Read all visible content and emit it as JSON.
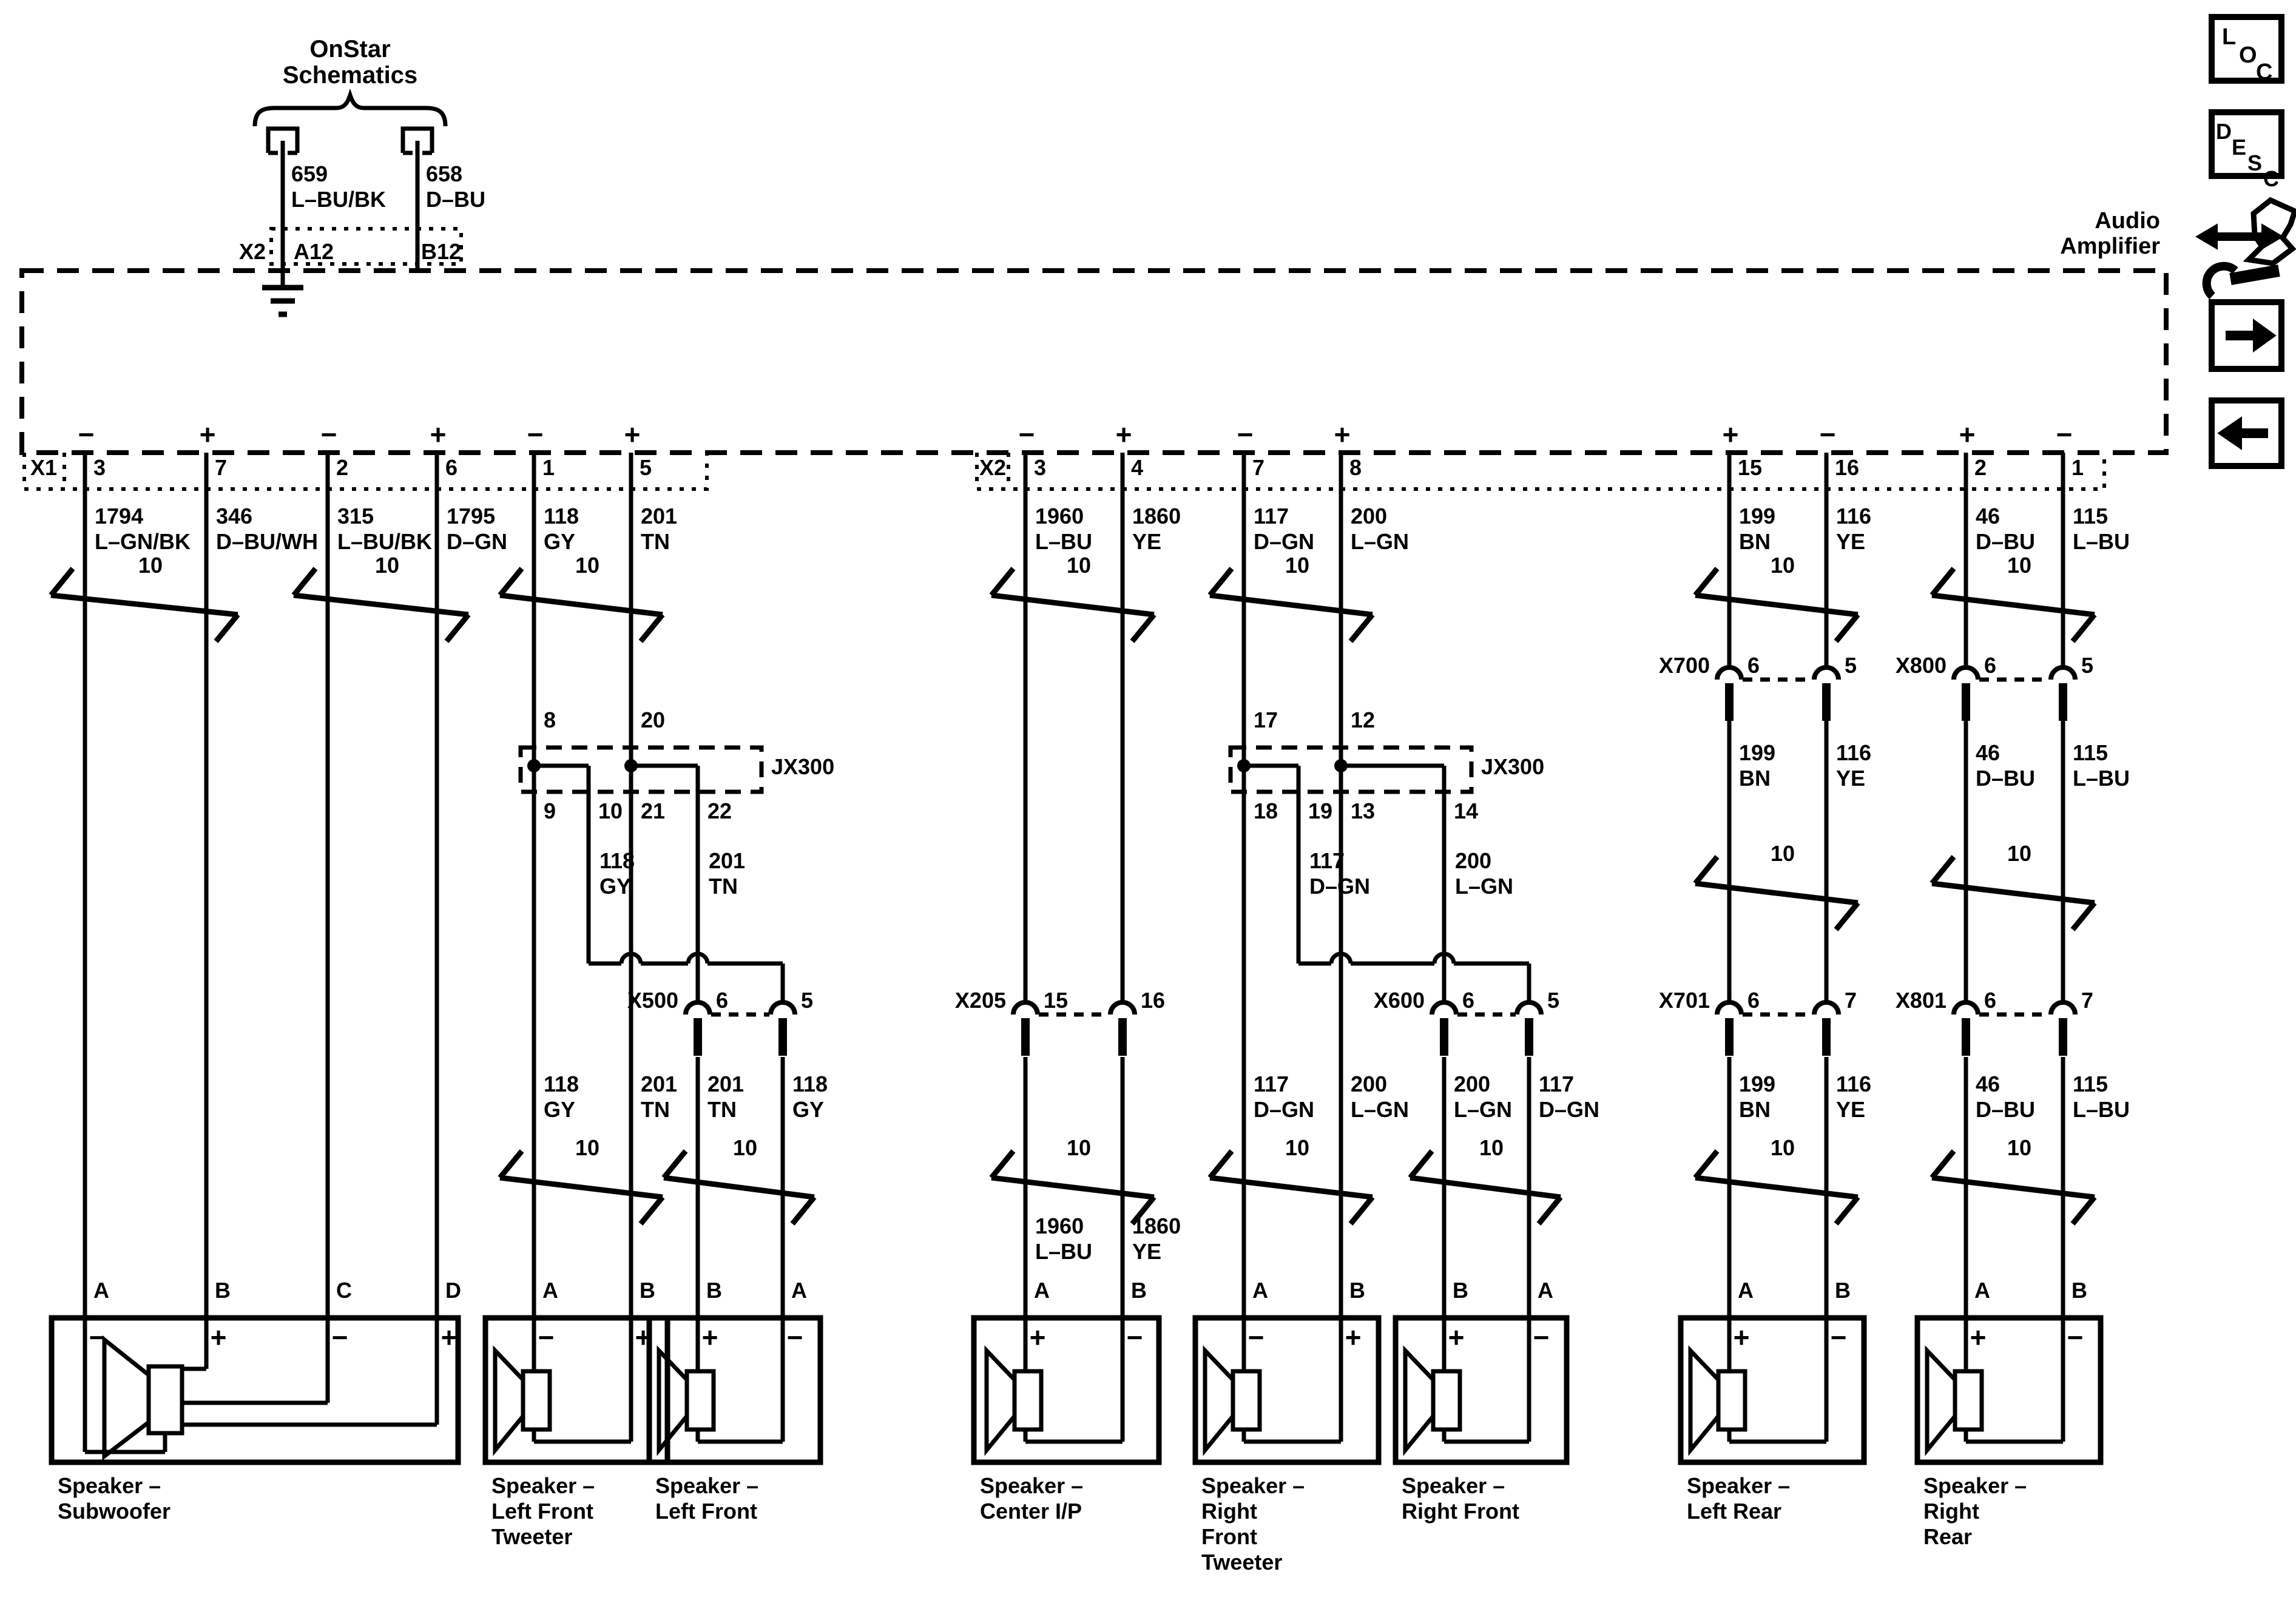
{
  "onstar": {
    "title1": "OnStar",
    "title2": "Schematics",
    "wire_left_id": "659",
    "wire_left_color": "L–BU/BK",
    "wire_right_id": "658",
    "wire_right_color": "D–BU",
    "conn_label": "X2",
    "pin_left": "A12",
    "pin_right": "B12"
  },
  "amp": {
    "name1": "Audio",
    "name2": "Amplifier",
    "x1": "X1",
    "x2": "X2"
  },
  "x1_pins": [
    {
      "n": "3",
      "s": "−"
    },
    {
      "n": "7",
      "s": "+"
    },
    {
      "n": "2",
      "s": "−"
    },
    {
      "n": "6",
      "s": "+"
    },
    {
      "n": "1",
      "s": "−"
    },
    {
      "n": "5",
      "s": "+"
    }
  ],
  "x2_pins": [
    {
      "n": "3",
      "s": "−"
    },
    {
      "n": "4",
      "s": "+"
    },
    {
      "n": "7",
      "s": "−"
    },
    {
      "n": "8",
      "s": "+"
    },
    {
      "n": "15",
      "s": "+"
    },
    {
      "n": "16",
      "s": "−"
    },
    {
      "n": "2",
      "s": "+"
    },
    {
      "n": "1",
      "s": "−"
    }
  ],
  "row1_labels": [
    {
      "id": "1794",
      "col": "L–GN/BK"
    },
    {
      "id": "346",
      "col": "D–BU/WH"
    },
    {
      "id": "315",
      "col": "L–BU/BK"
    },
    {
      "id": "1795",
      "col": "D–GN"
    },
    {
      "id": "118",
      "col": "GY"
    },
    {
      "id": "201",
      "col": "TN"
    },
    {
      "id": "1960",
      "col": "L–BU"
    },
    {
      "id": "1860",
      "col": "YE"
    },
    {
      "id": "117",
      "col": "D–GN"
    },
    {
      "id": "200",
      "col": "L–GN"
    },
    {
      "id": "199",
      "col": "BN"
    },
    {
      "id": "116",
      "col": "YE"
    },
    {
      "id": "46",
      "col": "D–BU"
    },
    {
      "id": "115",
      "col": "L–BU"
    }
  ],
  "rear_mid_labels": [
    {
      "id": "199",
      "col": "BN"
    },
    {
      "id": "116",
      "col": "YE"
    },
    {
      "id": "46",
      "col": "D–BU"
    },
    {
      "id": "115",
      "col": "L–BU"
    }
  ],
  "row3_labels": [
    {
      "id": "118",
      "col": "GY"
    },
    {
      "id": "201",
      "col": "TN"
    },
    {
      "id": "201",
      "col": "TN"
    },
    {
      "id": "118",
      "col": "GY"
    },
    {
      "id": "117",
      "col": "D–GN"
    },
    {
      "id": "200",
      "col": "L–GN"
    },
    {
      "id": "200",
      "col": "L–GN"
    },
    {
      "id": "117",
      "col": "D–GN"
    },
    {
      "id": "199",
      "col": "BN"
    },
    {
      "id": "116",
      "col": "YE"
    },
    {
      "id": "46",
      "col": "D–BU"
    },
    {
      "id": "115",
      "col": "L–BU"
    }
  ],
  "center_labels": [
    {
      "id": "1960",
      "col": "L–BU"
    },
    {
      "id": "1860",
      "col": "YE"
    }
  ],
  "shield_label": "10",
  "jx300_left": {
    "name": "JX300",
    "top_pins": [
      "8",
      "20"
    ],
    "bottom_pins": [
      "9",
      "10",
      "21",
      "22"
    ],
    "branch_labels": [
      {
        "id": "118",
        "col": "GY"
      },
      {
        "id": "201",
        "col": "TN"
      }
    ]
  },
  "jx300_right": {
    "name": "JX300",
    "top_pins": [
      "17",
      "12"
    ],
    "bottom_pins": [
      "18",
      "19",
      "13",
      "14"
    ],
    "branch_labels": [
      {
        "id": "117",
        "col": "D–GN"
      },
      {
        "id": "200",
        "col": "L–GN"
      }
    ]
  },
  "connectors_mid": [
    {
      "name": "X700",
      "p1": "6",
      "p2": "5"
    },
    {
      "name": "X800",
      "p1": "6",
      "p2": "5"
    }
  ],
  "connectors_row2": [
    {
      "name": "X500",
      "p1": "6",
      "p2": "5"
    },
    {
      "name": "X205",
      "p1": "15",
      "p2": "16"
    },
    {
      "name": "X600",
      "p1": "6",
      "p2": "5"
    },
    {
      "name": "X701",
      "p1": "6",
      "p2": "7"
    },
    {
      "name": "X801",
      "p1": "6",
      "p2": "7"
    }
  ],
  "speakers": [
    {
      "pins": [
        {
          "l": "A",
          "s": "−"
        },
        {
          "l": "B",
          "s": "+"
        },
        {
          "l": "C",
          "s": "−"
        },
        {
          "l": "D",
          "s": "+"
        }
      ],
      "label": [
        "Speaker –",
        "Subwoofer"
      ]
    },
    {
      "pins": [
        {
          "l": "A",
          "s": "−"
        },
        {
          "l": "B",
          "s": "+"
        }
      ],
      "label": [
        "Speaker –",
        "Left Front",
        "Tweeter"
      ]
    },
    {
      "pins": [
        {
          "l": "B",
          "s": "+"
        },
        {
          "l": "A",
          "s": "−"
        }
      ],
      "label": [
        "Speaker –",
        "Left Front"
      ]
    },
    {
      "pins": [
        {
          "l": "A",
          "s": "+"
        },
        {
          "l": "B",
          "s": "−"
        }
      ],
      "label": [
        "Speaker –",
        "Center I/P"
      ]
    },
    {
      "pins": [
        {
          "l": "A",
          "s": "−"
        },
        {
          "l": "B",
          "s": "+"
        }
      ],
      "label": [
        "Speaker –",
        "Right",
        "Front",
        "Tweeter"
      ]
    },
    {
      "pins": [
        {
          "l": "B",
          "s": "+"
        },
        {
          "l": "A",
          "s": "−"
        }
      ],
      "label": [
        "Speaker –",
        "Right Front"
      ]
    },
    {
      "pins": [
        {
          "l": "A",
          "s": "+"
        },
        {
          "l": "B",
          "s": "−"
        }
      ],
      "label": [
        "Speaker –",
        "Left Rear"
      ]
    },
    {
      "pins": [
        {
          "l": "A",
          "s": "+"
        },
        {
          "l": "B",
          "s": "−"
        }
      ],
      "label": [
        "Speaker –",
        "Right",
        "Rear"
      ]
    }
  ],
  "sidebar": {
    "loc": [
      "L",
      "O",
      "C"
    ],
    "desc": [
      "D",
      "E",
      "S",
      "C"
    ]
  }
}
